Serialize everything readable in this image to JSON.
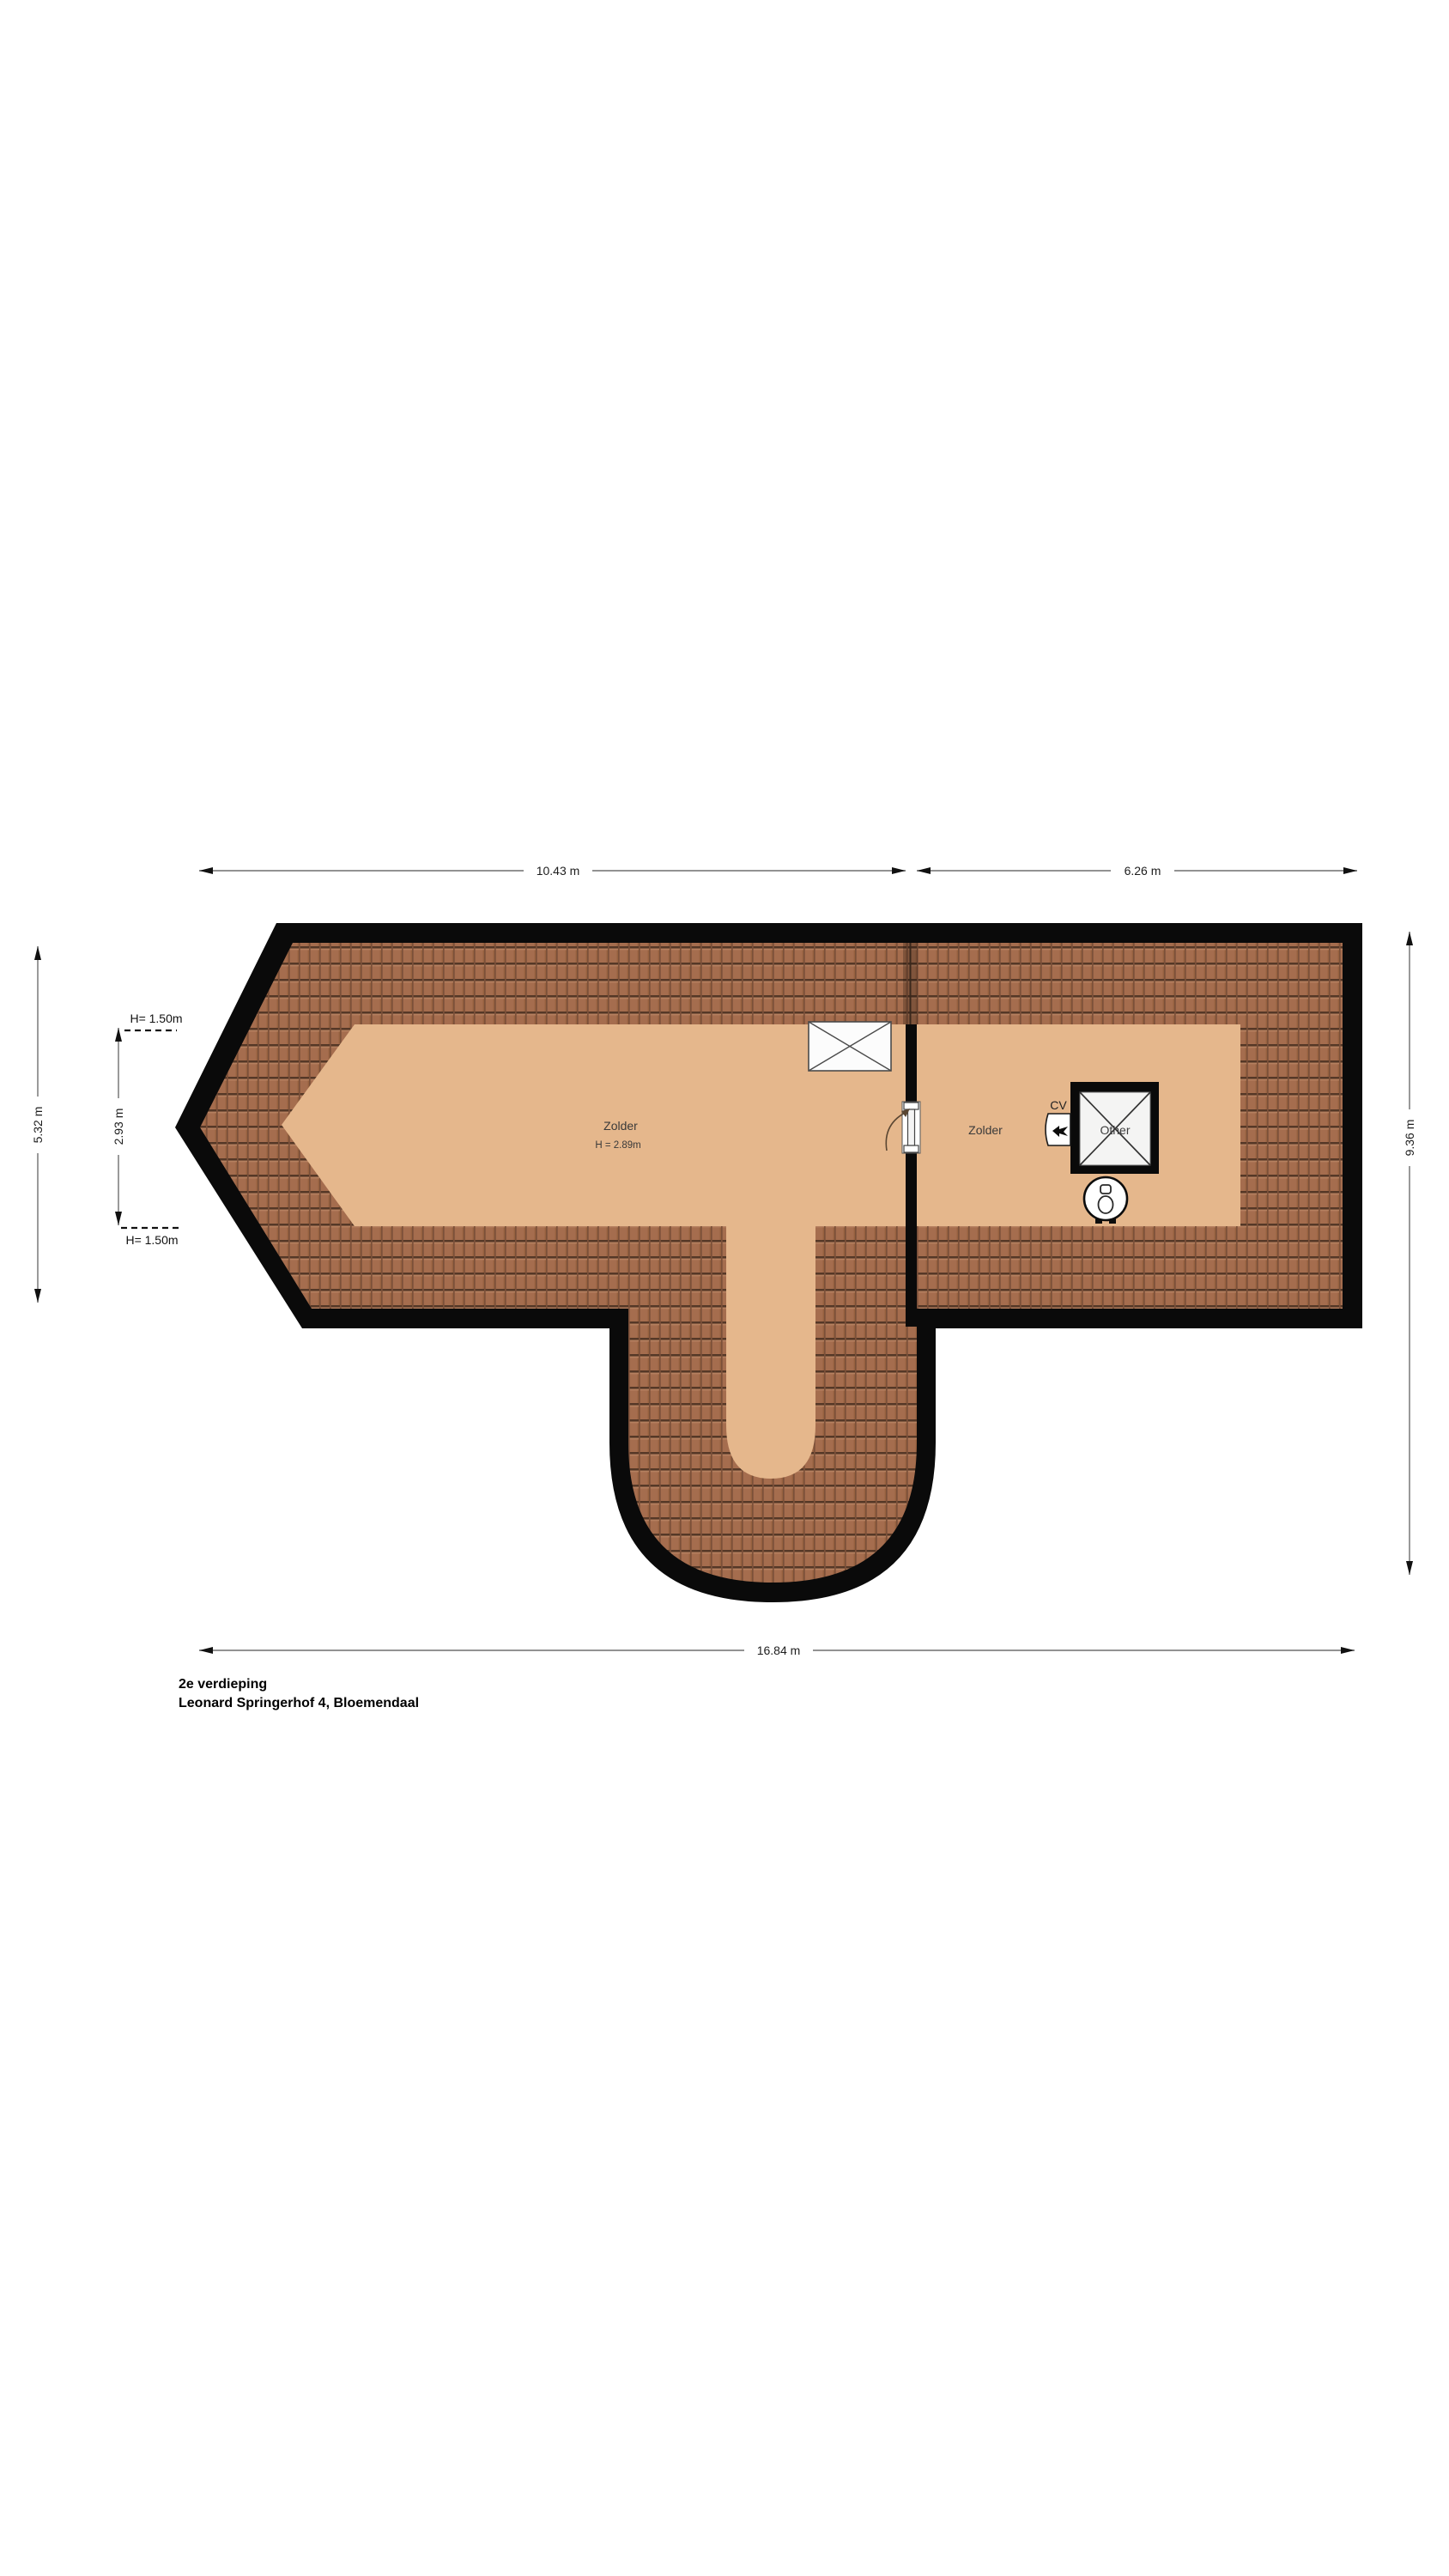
{
  "plan": {
    "footer": {
      "floor_label": "2e verdieping",
      "address": "Leonard Springerhof 4, Bloemendaal"
    },
    "rooms": {
      "left": {
        "name": "Zolder",
        "height_label": "H = 2.89m"
      },
      "right": {
        "name": "Zolder"
      },
      "shaft": {
        "label": "Other"
      },
      "cv": {
        "label": "CV"
      }
    },
    "dimensions": {
      "top_left": "10.43 m",
      "top_right": "6.26 m",
      "bottom": "16.84 m",
      "right": "9.36 m",
      "left_outer": "5.32 m",
      "left_inner": "2.93 m",
      "height_top": "H= 1.50m",
      "height_bottom": "H= 1.50m"
    },
    "icons": {
      "skylight": "skylight-window-icon",
      "door": "door-swing-icon",
      "shaft": "shaft-cross-icon",
      "cv_unit": "cv-boiler-icon",
      "toilet": "toilet-icon"
    },
    "colors": {
      "floor": "#e5b78c",
      "roof_tile": "#a56d4e",
      "outline": "#0a0a0a"
    }
  }
}
